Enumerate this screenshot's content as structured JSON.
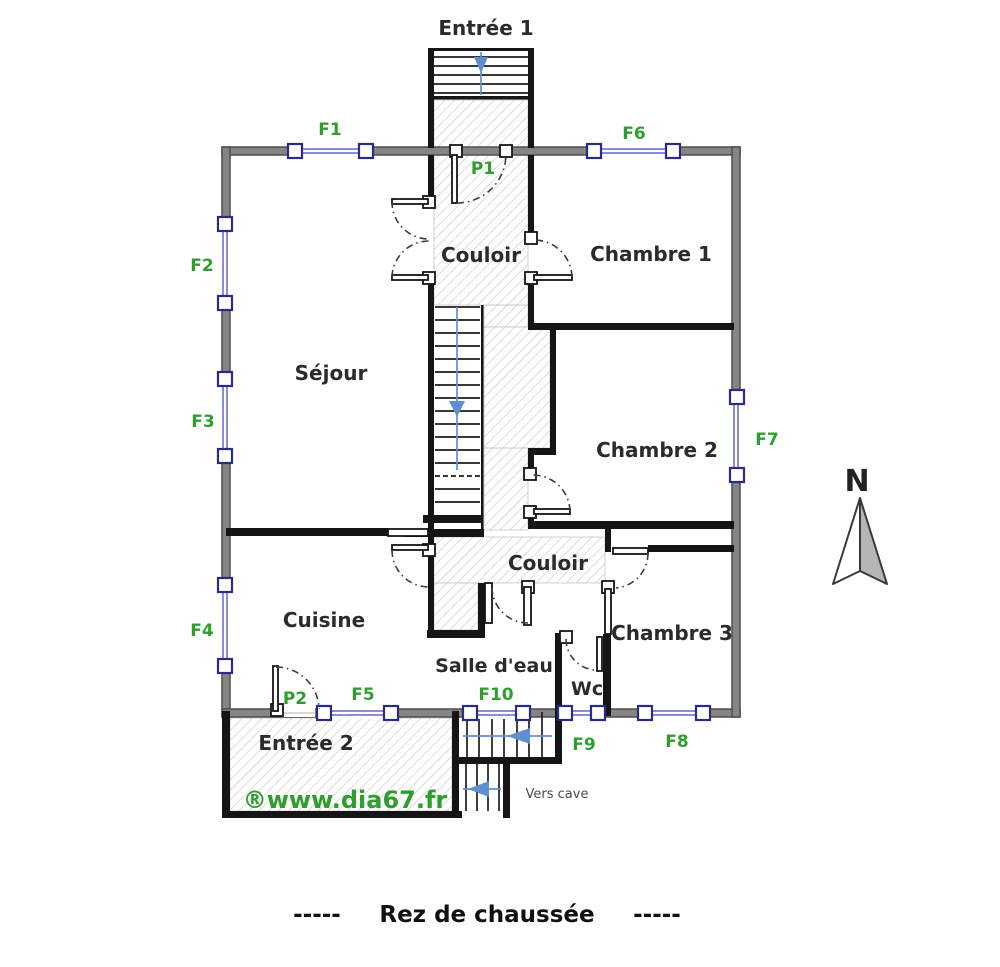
{
  "rooms": {
    "entree1": "Entrée 1",
    "couloir_haut": "Couloir",
    "chambre1": "Chambre 1",
    "sejour": "Séjour",
    "chambre2": "Chambre 2",
    "couloir_bas": "Couloir",
    "cuisine": "Cuisine",
    "chambre3": "Chambre 3",
    "salle_deau": "Salle d'eau",
    "wc": "Wc",
    "entree2": "Entrée 2"
  },
  "windows": {
    "f1": "F1",
    "f2": "F2",
    "f3": "F3",
    "f4": "F4",
    "f5": "F5",
    "f6": "F6",
    "f7": "F7",
    "f8": "F8",
    "f9": "F9",
    "f10": "F10"
  },
  "doors": {
    "p1": "P1",
    "p2": "P2"
  },
  "stairs": {
    "cellar_note": "Vers cave"
  },
  "compass": {
    "north": "N"
  },
  "watermark": "®www.dia67.fr",
  "title": {
    "left": "-----",
    "text": "Rez de chaussée",
    "right": "-----"
  },
  "colors": {
    "outer_wall": "#858585",
    "inner_wall": "#151515",
    "window_blue": "#8c8cd8",
    "window_frame": "#2b2b85",
    "label_green": "#2f9e2f",
    "stair_arrow_blue": "#5f8fd0",
    "hatch_gray": "#c6c6c6"
  }
}
